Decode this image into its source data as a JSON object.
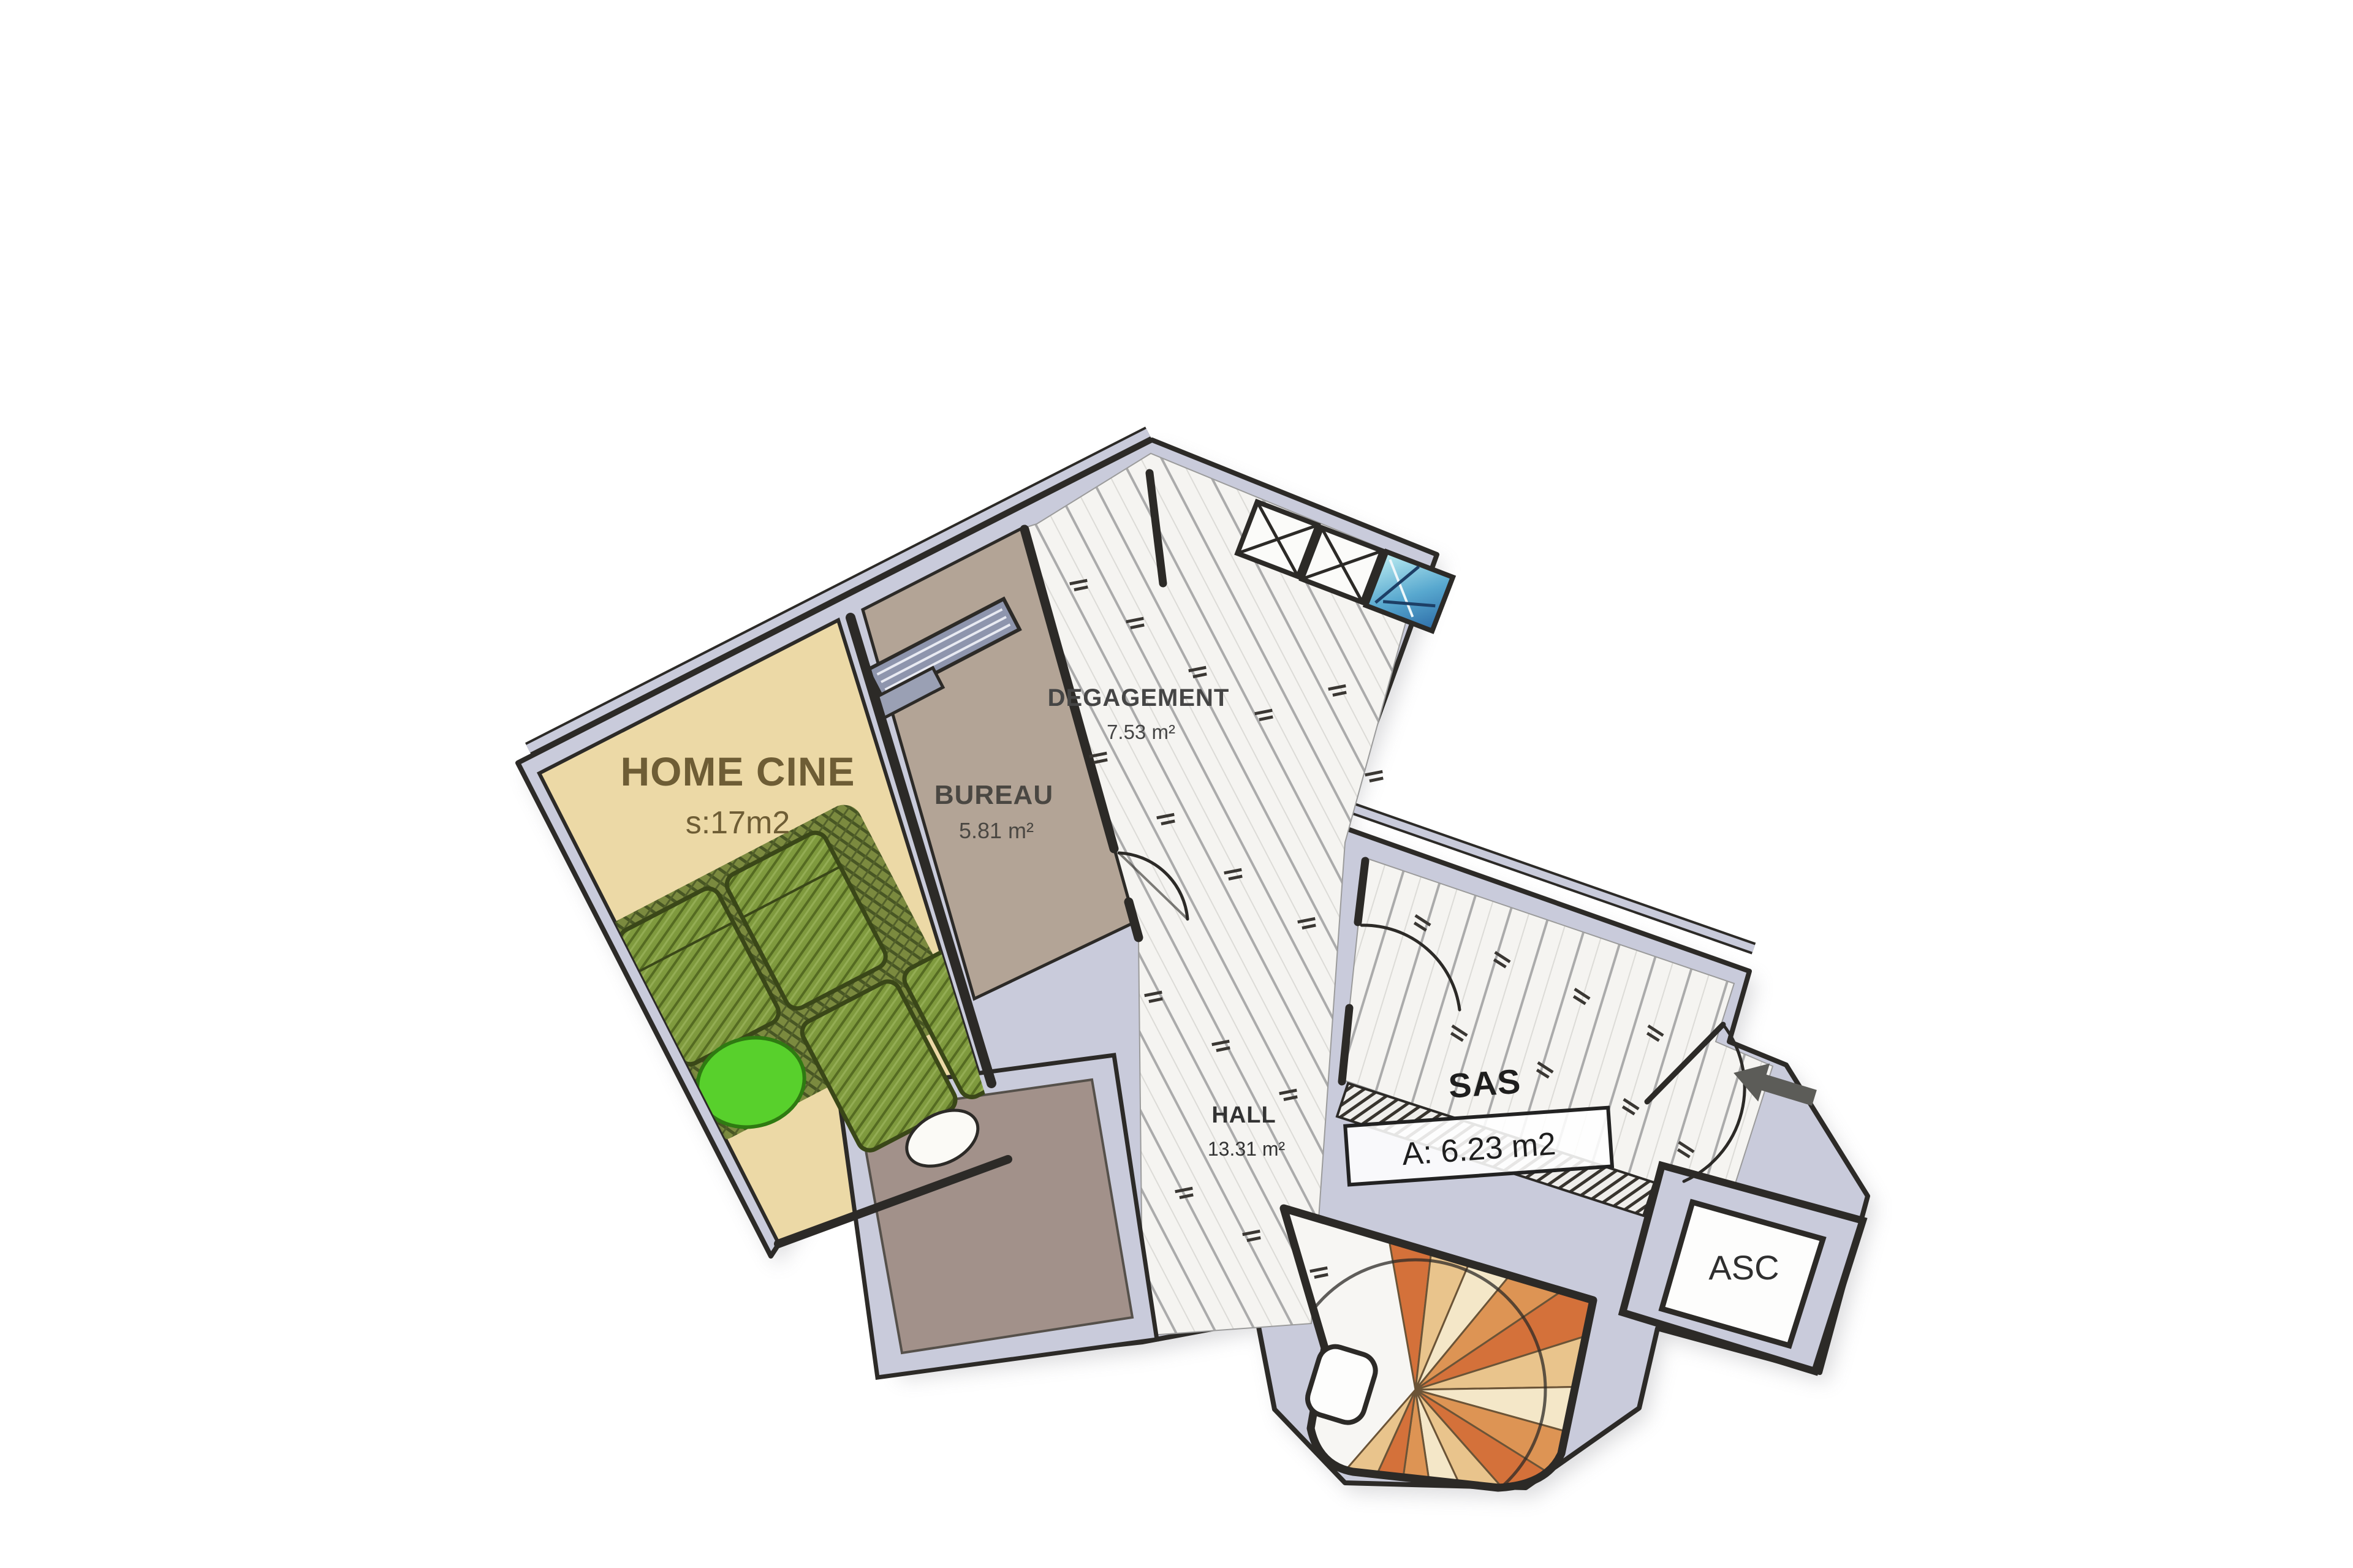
{
  "plan": {
    "type": "hand-drawn apartment floor plan",
    "orientation_note": "two wings rotated, entry at right"
  },
  "rooms": {
    "home_cine": {
      "label": "HOME CINE",
      "area": "s:17m2"
    },
    "bureau": {
      "label": "BUREAU",
      "area": "5.81 m²"
    },
    "degagement": {
      "label": "DEGAGEMENT",
      "area": "7.53 m²"
    },
    "hall": {
      "label": "HALL",
      "area": "13.31 m²"
    },
    "sas": {
      "label": "SAS",
      "area": "A: 6.23 m2"
    },
    "asc": {
      "label": "ASC"
    }
  },
  "icons": {
    "entry_arrow": "entry-direction-arrow",
    "skylight_x": "roof-window-crossed-box",
    "skylight_blue": "blue-roof-window",
    "spiral_stair": "spiral-staircase",
    "door_arc": "door-swing-arc"
  },
  "colors": {
    "background": "#ffffff",
    "wall_fill": "#c9cbdb",
    "wall_line": "#2c2a27",
    "home_cine_floor": "#ecd9a6",
    "bureau_floor": "#b3a496",
    "plank_floor": "#f5f4f1",
    "plank_line": "#ababab",
    "terrace_floor": "#a2918a",
    "sofa_green": "#7f9a3e",
    "sofa_dark": "#3a4718",
    "rug_green": "#75863a",
    "beanbag_green": "#58d02c",
    "stair_orange": "#d4713a",
    "stair_tan": "#e9c48c",
    "stair_cream": "#f4e7c8",
    "stair_amber": "#dd9454",
    "skylight_blue": "#58a8cf",
    "arrow_gray": "#5c5c58",
    "label_brown": "#6e5d35",
    "label_gray": "#4a4742"
  }
}
